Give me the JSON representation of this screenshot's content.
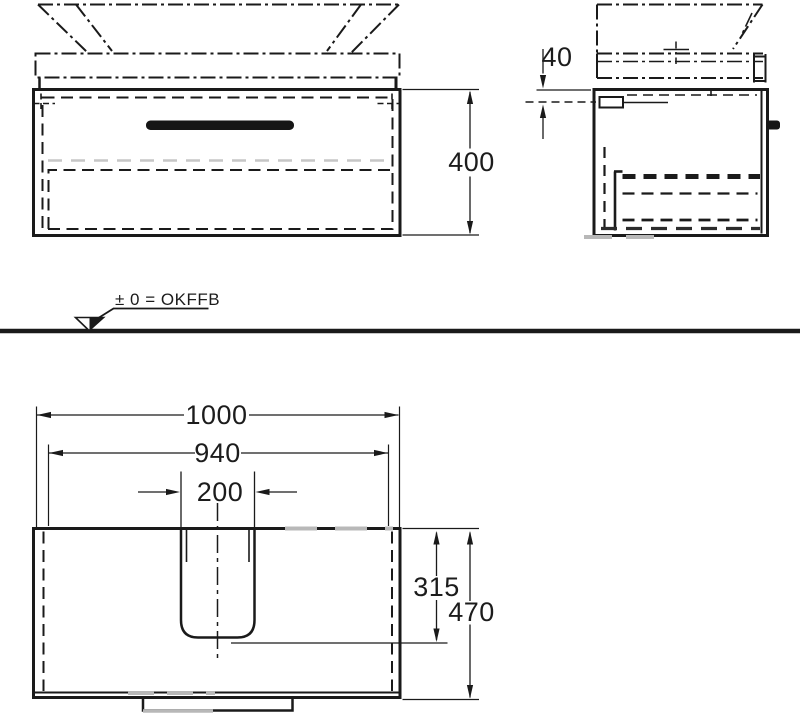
{
  "drawing": {
    "datum": {
      "label": "± 0 = OKFFB"
    },
    "dimensions": {
      "cabinet_height": "400",
      "countertop_offset": "40",
      "overall_width": "1000",
      "inner_width": "940",
      "cutout_width": "200",
      "cutout_depth": "315",
      "overall_depth": "470"
    },
    "line_color": "#1a1a1a",
    "ghost_color": "#b8b8b8"
  }
}
